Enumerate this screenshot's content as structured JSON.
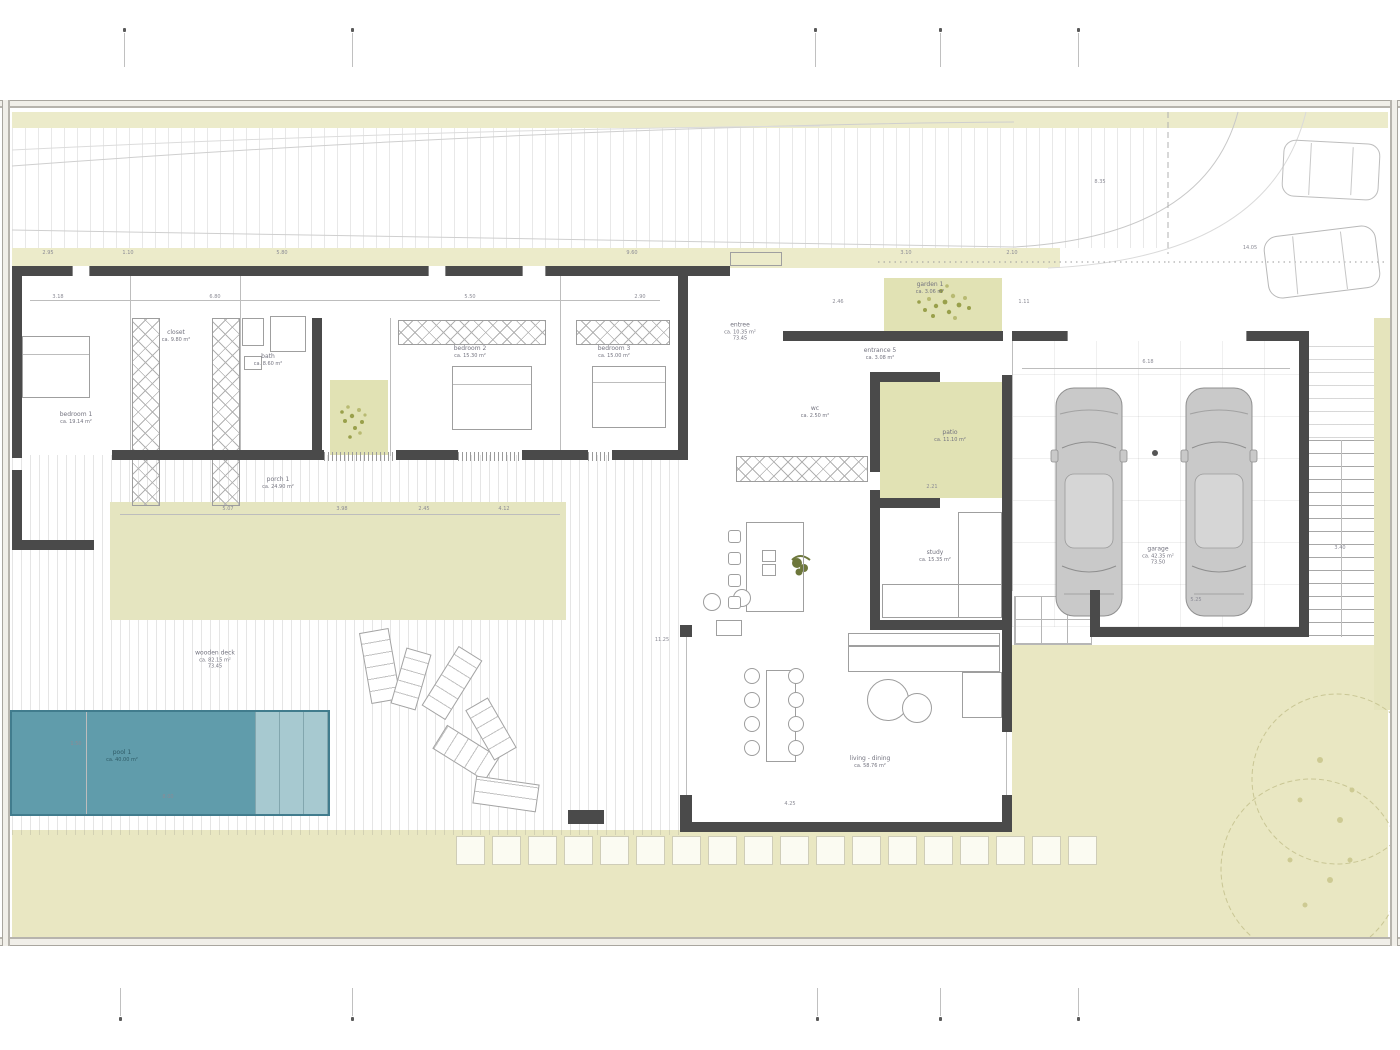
{
  "sheet": {
    "kind": "architectural floor plan",
    "bg": "#ffffff"
  },
  "colors": {
    "lawn": "#e9e7c2",
    "band": "#ecebca",
    "patio_green": "#e1e2b4",
    "terrace_green": "#e5e5c0",
    "pool": "#609cab",
    "pool_step": "#a7c9d0",
    "pool_edge": "#417c8d",
    "wall": "#4a4a4a",
    "line": "#bdbdbd",
    "label": "#73737f",
    "tree": "#c9c694",
    "shrub": "#99a04b"
  },
  "rooms": [
    {
      "name": "bedroom-1",
      "x": 76,
      "y": 418,
      "l1": "bedroom 1",
      "l2": "ca. 19.14 m²"
    },
    {
      "name": "closet",
      "x": 176,
      "y": 336,
      "l1": "closet",
      "l2": "ca. 9.80 m²"
    },
    {
      "name": "bath",
      "x": 268,
      "y": 360,
      "l1": "bath",
      "l2": "ca. 8.60 m²"
    },
    {
      "name": "bedroom-2",
      "x": 470,
      "y": 352,
      "l1": "bedroom 2",
      "l2": "ca. 15.30 m²"
    },
    {
      "name": "bedroom-3",
      "x": 614,
      "y": 352,
      "l1": "bedroom 3",
      "l2": "ca. 15.00 m²"
    },
    {
      "name": "porch",
      "x": 278,
      "y": 483,
      "l1": "porch 1",
      "l2": "ca. 24.90 m²"
    },
    {
      "name": "entree",
      "x": 740,
      "y": 332,
      "l1": "entree",
      "l2": "ca. 10.35 m²",
      "l3": "73.45"
    },
    {
      "name": "garden-1",
      "x": 930,
      "y": 288,
      "l1": "garden 1",
      "l2": "ca. 3.06 m²"
    },
    {
      "name": "entrance",
      "x": 880,
      "y": 354,
      "l1": "entrance 5",
      "l2": "ca. 3.08 m²"
    },
    {
      "name": "patio",
      "x": 950,
      "y": 436,
      "l1": "patio",
      "l2": "ca. 11.10 m²"
    },
    {
      "name": "wc",
      "x": 815,
      "y": 412,
      "l1": "wc",
      "l2": "ca. 2.50 m²"
    },
    {
      "name": "study",
      "x": 935,
      "y": 556,
      "l1": "study",
      "l2": "ca. 15.35 m²"
    },
    {
      "name": "living",
      "x": 870,
      "y": 762,
      "l1": "living - dining",
      "l2": "ca. 58.76 m²"
    },
    {
      "name": "garage",
      "x": 1158,
      "y": 556,
      "l1": "garage",
      "l2": "ca. 42.35 m²",
      "l3": "73.50"
    },
    {
      "name": "pool",
      "x": 122,
      "y": 756,
      "l1": "pool 1",
      "l2": "ca. 40.00 m²",
      "c": "pool-c"
    },
    {
      "name": "deck",
      "x": 215,
      "y": 660,
      "l1": "wooden deck",
      "l2": "ca. 82.15 m²",
      "l3": "73.45"
    }
  ],
  "dims": [
    {
      "t": "2.95",
      "x": 48,
      "y": 253
    },
    {
      "t": "1.10",
      "x": 128,
      "y": 253
    },
    {
      "t": "5.80",
      "x": 282,
      "y": 253
    },
    {
      "t": "9.60",
      "x": 632,
      "y": 253
    },
    {
      "t": "3.10",
      "x": 906,
      "y": 253
    },
    {
      "t": "2.10",
      "x": 1012,
      "y": 253
    },
    {
      "t": "14.05",
      "x": 1250,
      "y": 248
    },
    {
      "t": "8.35",
      "x": 1100,
      "y": 182
    },
    {
      "t": "3.18",
      "x": 58,
      "y": 297
    },
    {
      "t": "6.80",
      "x": 215,
      "y": 297
    },
    {
      "t": "5.50",
      "x": 470,
      "y": 297
    },
    {
      "t": "2.90",
      "x": 640,
      "y": 297
    },
    {
      "t": "5.07",
      "x": 228,
      "y": 509
    },
    {
      "t": "3.98",
      "x": 342,
      "y": 509
    },
    {
      "t": "2.45",
      "x": 424,
      "y": 509
    },
    {
      "t": "4.12",
      "x": 504,
      "y": 509
    },
    {
      "t": "11.25",
      "x": 662,
      "y": 640
    },
    {
      "t": "4.25",
      "x": 790,
      "y": 804
    },
    {
      "t": "2.21",
      "x": 932,
      "y": 487
    },
    {
      "t": "6.18",
      "x": 1148,
      "y": 362
    },
    {
      "t": "1.50",
      "x": 76,
      "y": 744
    },
    {
      "t": "8.00",
      "x": 168,
      "y": 797
    },
    {
      "t": "3.40",
      "x": 1340,
      "y": 548
    },
    {
      "t": "5.25",
      "x": 1196,
      "y": 600
    },
    {
      "t": "2.46",
      "x": 838,
      "y": 302
    },
    {
      "t": "1.11",
      "x": 1024,
      "y": 302
    }
  ],
  "markers": {
    "top": [
      124,
      352,
      815,
      940,
      1078
    ],
    "bottom": [
      120,
      352,
      817,
      940,
      1078
    ]
  },
  "figures": {
    "walls": [
      [
        12,
        266,
        60,
        10
      ],
      [
        90,
        266,
        338,
        10
      ],
      [
        446,
        266,
        76,
        10
      ],
      [
        546,
        266,
        184,
        10
      ],
      [
        783,
        331,
        220,
        10
      ],
      [
        1012,
        331,
        55,
        10
      ],
      [
        1247,
        331,
        62,
        10
      ],
      [
        12,
        266,
        10,
        192
      ],
      [
        12,
        470,
        10,
        80
      ],
      [
        12,
        540,
        82,
        10
      ],
      [
        312,
        318,
        10,
        140
      ],
      [
        678,
        276,
        10,
        184
      ],
      [
        112,
        450,
        212,
        10
      ],
      [
        396,
        450,
        62,
        10
      ],
      [
        522,
        450,
        66,
        10
      ],
      [
        612,
        450,
        76,
        10
      ],
      [
        870,
        372,
        70,
        10
      ],
      [
        870,
        372,
        10,
        100
      ],
      [
        870,
        490,
        10,
        140
      ],
      [
        870,
        498,
        70,
        10
      ],
      [
        1002,
        375,
        10,
        357
      ],
      [
        870,
        620,
        142,
        10
      ],
      [
        1299,
        331,
        10,
        306
      ],
      [
        1090,
        627,
        219,
        10
      ],
      [
        1090,
        590,
        10,
        45
      ],
      [
        680,
        625,
        12,
        12
      ],
      [
        680,
        795,
        12,
        37
      ],
      [
        682,
        822,
        330,
        10
      ],
      [
        1002,
        795,
        10,
        37
      ],
      [
        568,
        810,
        36,
        14
      ]
    ],
    "wins": [
      [
        72,
        266,
        18,
        10
      ],
      [
        428,
        266,
        18,
        10
      ],
      [
        522,
        266,
        24,
        10
      ],
      [
        1067,
        331,
        180,
        10
      ]
    ],
    "sills": [
      [
        324,
        452,
        72,
        9
      ],
      [
        458,
        452,
        64,
        9
      ],
      [
        588,
        452,
        24,
        9
      ]
    ],
    "lines": [
      [
        686,
        625,
        1,
        200
      ],
      [
        1006,
        732,
        1,
        64
      ],
      [
        1012,
        341,
        1,
        250
      ],
      [
        86,
        712,
        1,
        102
      ],
      [
        1341,
        440,
        1,
        197
      ],
      [
        130,
        276,
        1,
        174
      ],
      [
        240,
        276,
        1,
        174
      ],
      [
        390,
        318,
        1,
        138
      ],
      [
        560,
        276,
        1,
        174
      ],
      [
        120,
        514,
        440,
        1
      ],
      [
        1022,
        368,
        268,
        1
      ],
      [
        30,
        300,
        630,
        1
      ],
      [
        22,
        354,
        68,
        1
      ],
      [
        452,
        384,
        80,
        1
      ],
      [
        592,
        382,
        74,
        1
      ]
    ],
    "thin": [
      [
        22,
        336,
        68,
        62
      ],
      [
        452,
        366,
        80,
        64
      ],
      [
        592,
        366,
        74,
        62
      ],
      [
        242,
        318,
        22,
        28
      ],
      [
        270,
        316,
        36,
        36
      ],
      [
        244,
        356,
        18,
        14
      ],
      [
        746,
        522,
        58,
        90
      ],
      [
        762,
        550,
        14,
        12
      ],
      [
        762,
        564,
        14,
        12
      ],
      [
        848,
        633,
        152,
        13
      ],
      [
        848,
        646,
        152,
        26
      ],
      [
        962,
        672,
        40,
        46
      ],
      [
        766,
        670,
        30,
        92
      ],
      [
        716,
        620,
        26,
        16
      ],
      [
        958,
        512,
        44,
        106
      ],
      [
        882,
        584,
        120,
        34
      ],
      [
        730,
        252,
        52,
        14
      ]
    ],
    "xcabs": [
      [
        132,
        318,
        28,
        188
      ],
      [
        212,
        318,
        28,
        188
      ],
      [
        736,
        456,
        132,
        26
      ],
      [
        398,
        320,
        148,
        25
      ],
      [
        576,
        320,
        94,
        25
      ]
    ],
    "circles": [
      [
        888,
        700,
        21
      ],
      [
        917,
        708,
        15
      ],
      [
        712,
        602,
        9
      ],
      [
        742,
        598,
        9
      ]
    ],
    "stools": [
      [
        728,
        530
      ],
      [
        728,
        552
      ],
      [
        728,
        574
      ],
      [
        728,
        596
      ]
    ],
    "dining": {
      "cols": [
        752,
        796
      ],
      "rows": [
        676,
        700,
        724,
        748
      ],
      "r": 8
    },
    "loungers": [
      [
        365,
        630,
        30,
        72,
        -10
      ],
      [
        398,
        650,
        26,
        58,
        16
      ],
      [
        438,
        648,
        28,
        70,
        32
      ],
      [
        452,
        722,
        28,
        62,
        -58
      ],
      [
        478,
        700,
        26,
        58,
        -30
      ],
      [
        474,
        780,
        64,
        28,
        8
      ]
    ],
    "stones": {
      "x": 456,
      "y": 836,
      "size": 29,
      "gap": 7,
      "count": 18
    }
  }
}
